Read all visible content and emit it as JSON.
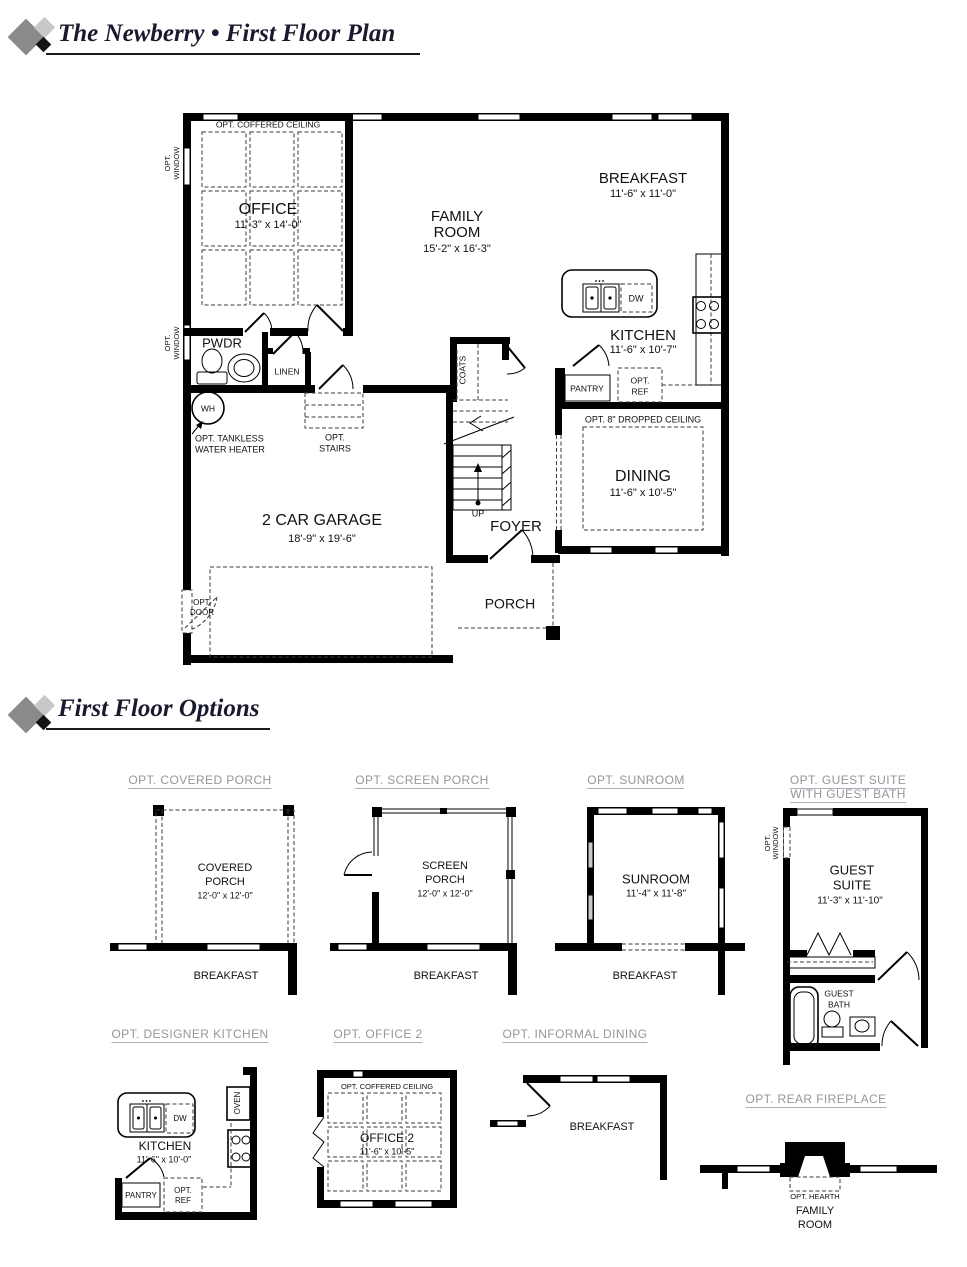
{
  "header": {
    "title": "The Newberry • First Floor Plan"
  },
  "options_header": {
    "title": "First Floor Options"
  },
  "plan": {
    "opt_coffered_ceiling": "OPT. COFFERED CEILING",
    "office": "OFFICE",
    "office_dims": "11'-3\" x 14'-0\"",
    "family1": "FAMILY",
    "family2": "ROOM",
    "family_dims": "15'-2\" x 16'-3\"",
    "breakfast": "BREAKFAST",
    "breakfast_dims": "11'-6\" x 11'-0\"",
    "kitchen": "KITCHEN",
    "kitchen_dims": "11'-6\" x 10'-7\"",
    "dw": "DW",
    "pantry": "PANTRY",
    "opt": "OPT.",
    "ref": "REF",
    "dropped_ceiling": "OPT. 8\" DROPPED CEILING",
    "dining": "DINING",
    "dining_dims": "11'-6\" x 10'-5\"",
    "pwdr": "PWDR",
    "linen": "LINEN",
    "wh": "WH",
    "tankless1": "OPT. TANKLESS",
    "tankless2": "WATER HEATER",
    "stairs": "STAIRS",
    "coats": "COATS",
    "up": "UP",
    "foyer": "FOYER",
    "garage": "2 CAR GARAGE",
    "garage_dims": "18'-9\" x 19'-6\"",
    "porch": "PORCH",
    "door": "DOOR",
    "window": "WINDOW"
  },
  "opt_covered_porch": {
    "title": "OPT. COVERED PORCH",
    "name1": "COVERED",
    "name2": "PORCH",
    "dims": "12'-0\" x 12'-0\"",
    "adjacent": "BREAKFAST"
  },
  "opt_screen_porch": {
    "title": "OPT. SCREEN PORCH",
    "name1": "SCREEN",
    "name2": "PORCH",
    "dims": "12'-0\" x 12'-0\"",
    "adjacent": "BREAKFAST"
  },
  "opt_sunroom": {
    "title": "OPT. SUNROOM",
    "name": "SUNROOM",
    "dims": "11'-4\" x 11'-8\"",
    "adjacent": "BREAKFAST"
  },
  "opt_guest_suite": {
    "title1": "OPT. GUEST SUITE",
    "title2": "WITH GUEST BATH",
    "name1": "GUEST",
    "name2": "SUITE",
    "dims": "11'-3\" x 11'-10\"",
    "bath1": "GUEST",
    "bath2": "BATH"
  },
  "opt_designer_kitchen": {
    "title": "OPT. DESIGNER KITCHEN",
    "name": "KITCHEN",
    "dims": "11'-6\" x 10'-0\"",
    "oven": "OVEN",
    "dw": "DW",
    "pantry": "PANTRY",
    "opt": "OPT.",
    "ref": "REF"
  },
  "opt_office2": {
    "title": "OPT. OFFICE 2",
    "ceiling": "OPT. COFFERED CEILING",
    "name": "OFFICE 2",
    "dims": "11'-6\" x 10'-5\""
  },
  "opt_informal_dining": {
    "title": "OPT. INFORMAL DINING",
    "adjacent": "BREAKFAST"
  },
  "opt_rear_fireplace": {
    "title": "OPT. REAR FIREPLACE",
    "hearth": "OPT. HEARTH",
    "name1": "FAMILY",
    "name2": "ROOM"
  },
  "colors": {
    "title_text": "#1a1a2e",
    "option_header": "#96969a",
    "line": "#000000"
  }
}
